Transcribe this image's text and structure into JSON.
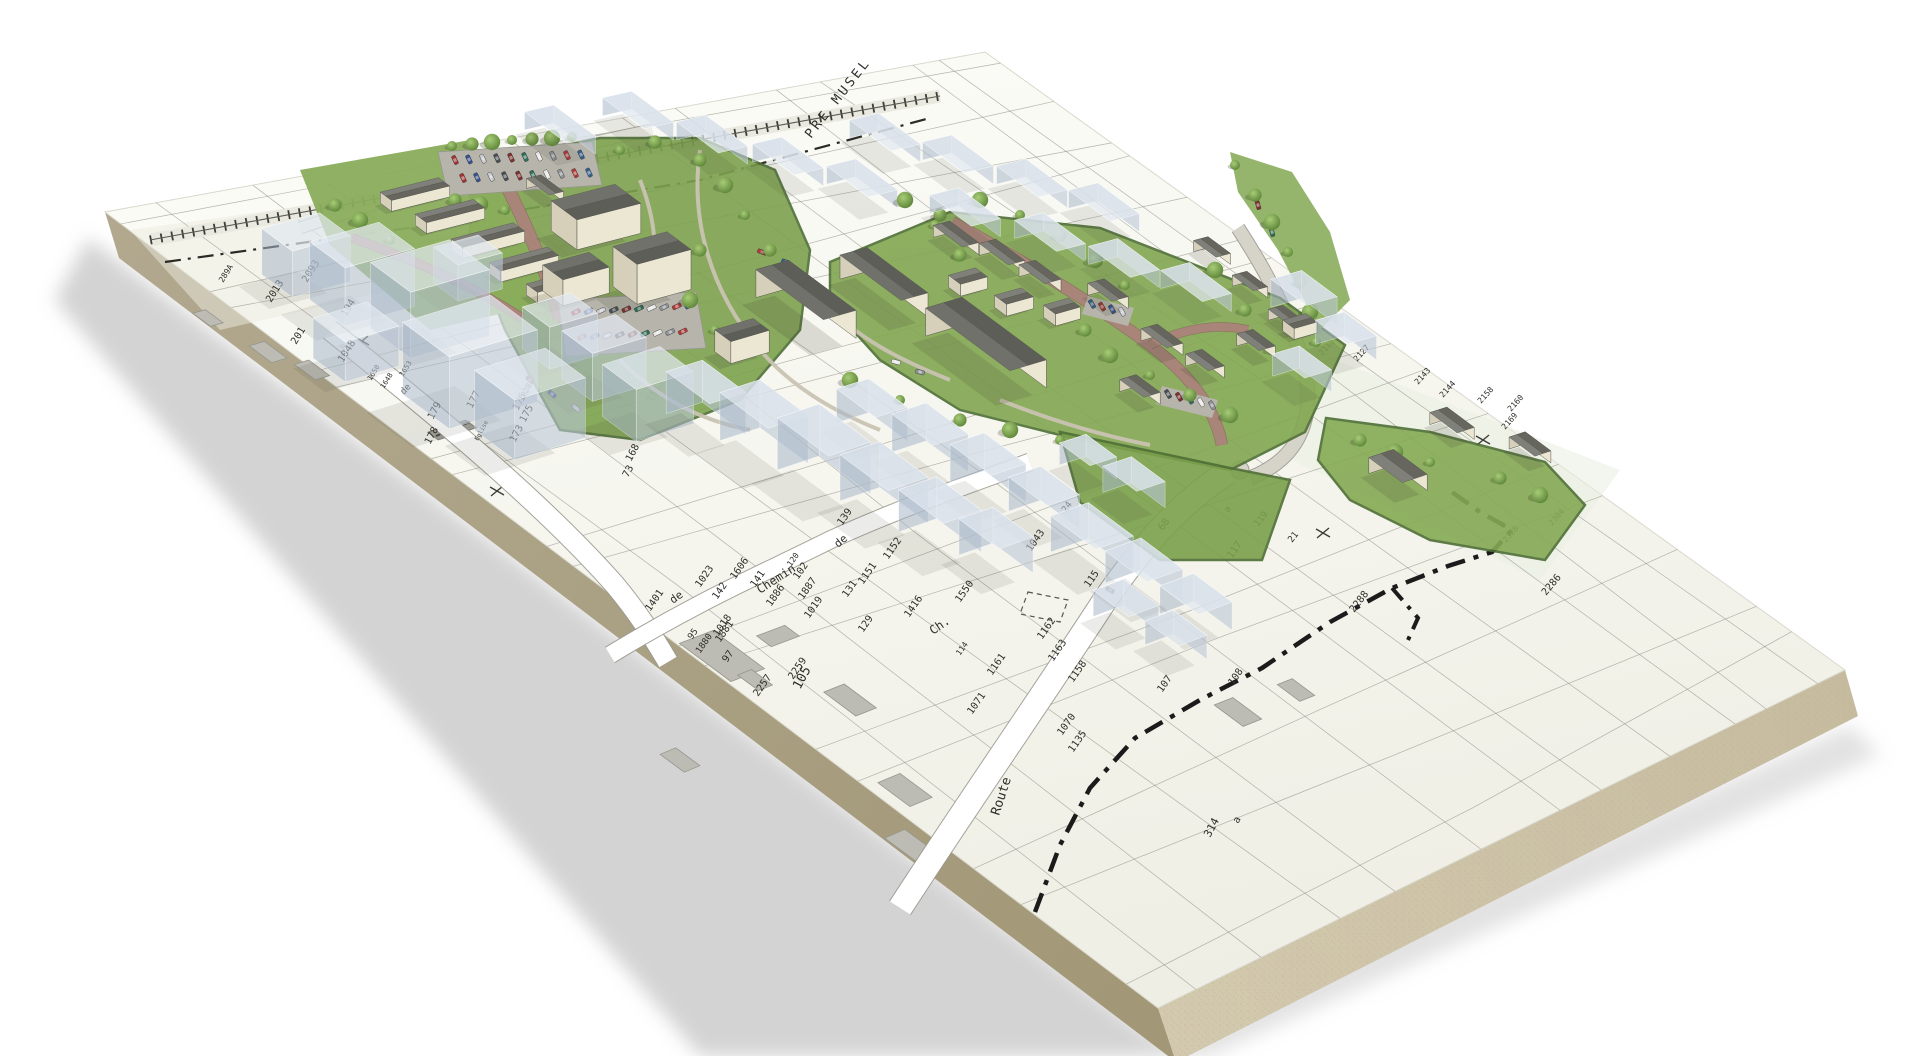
{
  "scene": {
    "name": "3d-cadastral-site-model",
    "board_color": "#f6f6f0",
    "board_far_color": "#fbfbf6",
    "edge_front_color": "#d3c9ae",
    "edge_side_color": "#a29877",
    "parcel_line_color": "#7d7d74",
    "green_color": "#7da24e",
    "green_dark": "#5c8138",
    "hedge_color": "#4e6f35",
    "road_red": "#a98579",
    "road_gray": "#d6d3c9",
    "path_gray": "#c9c3b2",
    "parking_gray": "#b7b5ab",
    "ghost_top": "rgba(225,232,240,0.72)",
    "ghost_wall_light": "rgba(186,198,213,0.60)",
    "ghost_wall_dark": "rgba(168,182,200,0.55)",
    "wall_light": "#ece7d3",
    "wall_dark": "#d6d0ba",
    "roof_light": "#80807a",
    "roof_dark": "#66665f",
    "boundary_color": "#1b1b1b",
    "label_color": "#2f2f2a"
  },
  "labels": {
    "area_labels": [
      {
        "text": "PRE MUSEL",
        "x": 811,
        "y": 139,
        "r": -52,
        "s": 13,
        "cls": "area-label"
      },
      {
        "text": "Eglise",
        "x": 478,
        "y": 441,
        "r": -62,
        "s": 6,
        "cls": ""
      }
    ],
    "street_labels": [
      {
        "text": "Route",
        "x": 999,
        "y": 816,
        "r": -72,
        "s": 13
      },
      {
        "text": "Chemin",
        "x": 760,
        "y": 594,
        "r": -33,
        "s": 12
      },
      {
        "text": "de",
        "x": 838,
        "y": 548,
        "r": -40,
        "s": 11
      },
      {
        "text": "de",
        "x": 673,
        "y": 604,
        "r": -36,
        "s": 11
      },
      {
        "text": "Ch.",
        "x": 933,
        "y": 635,
        "r": -35,
        "s": 12
      },
      {
        "text": "de",
        "x": 404,
        "y": 395,
        "r": -48,
        "s": 9
      }
    ],
    "parcel_labels": [
      {
        "text": "1513",
        "x": 652,
        "y": 403,
        "r": -60,
        "s": 10
      },
      {
        "text": "1515",
        "x": 637,
        "y": 357,
        "r": -60,
        "s": 10
      },
      {
        "text": "168",
        "x": 631,
        "y": 462,
        "r": -62,
        "s": 10
      },
      {
        "text": "73",
        "x": 628,
        "y": 478,
        "r": -62,
        "s": 10
      },
      {
        "text": "177",
        "x": 472,
        "y": 409,
        "r": -62,
        "s": 10
      },
      {
        "text": "179",
        "x": 433,
        "y": 420,
        "r": -62,
        "s": 10
      },
      {
        "text": "178",
        "x": 430,
        "y": 445,
        "r": -62,
        "s": 10
      },
      {
        "text": "176",
        "x": 518,
        "y": 411,
        "r": -62,
        "s": 10
      },
      {
        "text": "175",
        "x": 525,
        "y": 423,
        "r": -62,
        "s": 10
      },
      {
        "text": "173",
        "x": 515,
        "y": 443,
        "r": -62,
        "s": 10
      },
      {
        "text": "1028",
        "x": 523,
        "y": 402,
        "r": -62,
        "s": 8
      },
      {
        "text": "2093",
        "x": 307,
        "y": 283,
        "r": -58,
        "s": 10
      },
      {
        "text": "2013",
        "x": 271,
        "y": 303,
        "r": -58,
        "s": 10
      },
      {
        "text": "289A",
        "x": 223,
        "y": 283,
        "r": -58,
        "s": 8
      },
      {
        "text": "194",
        "x": 346,
        "y": 317,
        "r": -58,
        "s": 10
      },
      {
        "text": "201",
        "x": 296,
        "y": 345,
        "r": -58,
        "s": 10
      },
      {
        "text": "1048",
        "x": 343,
        "y": 363,
        "r": -58,
        "s": 10
      },
      {
        "text": "1650",
        "x": 371,
        "y": 381,
        "r": -58,
        "s": 7
      },
      {
        "text": "1648",
        "x": 384,
        "y": 389,
        "r": -58,
        "s": 7
      },
      {
        "text": "1653",
        "x": 403,
        "y": 377,
        "r": -58,
        "s": 7
      },
      {
        "text": "1023",
        "x": 700,
        "y": 588,
        "r": -55,
        "s": 10
      },
      {
        "text": "142",
        "x": 717,
        "y": 600,
        "r": -55,
        "s": 10
      },
      {
        "text": "1606",
        "x": 735,
        "y": 580,
        "r": -55,
        "s": 10
      },
      {
        "text": "141",
        "x": 755,
        "y": 588,
        "r": -55,
        "s": 10
      },
      {
        "text": "102",
        "x": 798,
        "y": 580,
        "r": -55,
        "s": 10
      },
      {
        "text": "120",
        "x": 791,
        "y": 567,
        "r": -55,
        "s": 8
      },
      {
        "text": "1886",
        "x": 771,
        "y": 607,
        "r": -55,
        "s": 10
      },
      {
        "text": "1887",
        "x": 803,
        "y": 600,
        "r": -55,
        "s": 10
      },
      {
        "text": "1019",
        "x": 809,
        "y": 619,
        "r": -55,
        "s": 10
      },
      {
        "text": "1018",
        "x": 718,
        "y": 637,
        "r": -55,
        "s": 10
      },
      {
        "text": "1401",
        "x": 650,
        "y": 612,
        "r": -55,
        "s": 10
      },
      {
        "text": "95",
        "x": 692,
        "y": 640,
        "r": -55,
        "s": 9
      },
      {
        "text": "1880",
        "x": 700,
        "y": 654,
        "r": -55,
        "s": 9
      },
      {
        "text": "1881",
        "x": 720,
        "y": 643,
        "r": -55,
        "s": 10
      },
      {
        "text": "97",
        "x": 727,
        "y": 663,
        "r": -55,
        "s": 10
      },
      {
        "text": "2259",
        "x": 793,
        "y": 680,
        "r": -55,
        "s": 10
      },
      {
        "text": "2257",
        "x": 758,
        "y": 697,
        "r": -55,
        "s": 10
      },
      {
        "text": "139",
        "x": 842,
        "y": 526,
        "r": -55,
        "s": 10
      },
      {
        "text": "129",
        "x": 863,
        "y": 633,
        "r": -55,
        "s": 10
      },
      {
        "text": "131",
        "x": 847,
        "y": 598,
        "r": -55,
        "s": 10
      },
      {
        "text": "1151",
        "x": 863,
        "y": 585,
        "r": -55,
        "s": 10
      },
      {
        "text": "1152",
        "x": 888,
        "y": 560,
        "r": -55,
        "s": 10
      },
      {
        "text": "1416",
        "x": 909,
        "y": 618,
        "r": -55,
        "s": 10
      },
      {
        "text": "1550",
        "x": 960,
        "y": 603,
        "r": -55,
        "s": 10
      },
      {
        "text": "114",
        "x": 960,
        "y": 656,
        "r": -55,
        "s": 8
      },
      {
        "text": "1161",
        "x": 992,
        "y": 676,
        "r": -55,
        "s": 10
      },
      {
        "text": "1162",
        "x": 1042,
        "y": 640,
        "r": -55,
        "s": 10
      },
      {
        "text": "1163",
        "x": 1053,
        "y": 662,
        "r": -55,
        "s": 10
      },
      {
        "text": "1158",
        "x": 1073,
        "y": 683,
        "r": -55,
        "s": 10
      },
      {
        "text": "1071",
        "x": 972,
        "y": 715,
        "r": -55,
        "s": 10
      },
      {
        "text": "1070",
        "x": 1062,
        "y": 736,
        "r": -55,
        "s": 10
      },
      {
        "text": "1135",
        "x": 1073,
        "y": 753,
        "r": -55,
        "s": 10
      },
      {
        "text": "107",
        "x": 1162,
        "y": 693,
        "r": -55,
        "s": 10
      },
      {
        "text": "108",
        "x": 1233,
        "y": 686,
        "r": -55,
        "s": 10
      },
      {
        "text": "314",
        "x": 1210,
        "y": 838,
        "r": -62,
        "s": 11
      },
      {
        "text": "105",
        "x": 800,
        "y": 690,
        "r": -62,
        "s": 13
      },
      {
        "text": "a",
        "x": 1238,
        "y": 824,
        "r": -60,
        "s": 10
      },
      {
        "text": "a",
        "x": 1228,
        "y": 513,
        "r": -52,
        "s": 9
      },
      {
        "text": "24",
        "x": 1066,
        "y": 513,
        "r": -55,
        "s": 9
      },
      {
        "text": "1043",
        "x": 1031,
        "y": 552,
        "r": -55,
        "s": 10
      },
      {
        "text": "115",
        "x": 1089,
        "y": 588,
        "r": -55,
        "s": 10
      },
      {
        "text": "68",
        "x": 1163,
        "y": 531,
        "r": -55,
        "s": 10
      },
      {
        "text": "117",
        "x": 1232,
        "y": 559,
        "r": -55,
        "s": 10
      },
      {
        "text": "119",
        "x": 1258,
        "y": 527,
        "r": -52,
        "s": 9
      },
      {
        "text": "21",
        "x": 1292,
        "y": 543,
        "r": -52,
        "s": 9
      },
      {
        "text": "2286",
        "x": 1546,
        "y": 596,
        "r": -50,
        "s": 10
      },
      {
        "text": "2288",
        "x": 1354,
        "y": 613,
        "r": -52,
        "s": 10
      },
      {
        "text": "2304",
        "x": 1552,
        "y": 526,
        "r": -48,
        "s": 8
      },
      {
        "text": "2328",
        "x": 1506,
        "y": 543,
        "r": -48,
        "s": 8
      },
      {
        "text": "2143",
        "x": 1418,
        "y": 385,
        "r": -48,
        "s": 8
      },
      {
        "text": "2144",
        "x": 1443,
        "y": 398,
        "r": -48,
        "s": 8
      },
      {
        "text": "2158",
        "x": 1481,
        "y": 404,
        "r": -48,
        "s": 8
      },
      {
        "text": "2160",
        "x": 1511,
        "y": 412,
        "r": -48,
        "s": 8
      },
      {
        "text": "2169",
        "x": 1505,
        "y": 430,
        "r": -48,
        "s": 8
      },
      {
        "text": "2115",
        "x": 1322,
        "y": 356,
        "r": -48,
        "s": 8
      },
      {
        "text": "2127",
        "x": 1357,
        "y": 362,
        "r": -48,
        "s": 8
      }
    ]
  }
}
